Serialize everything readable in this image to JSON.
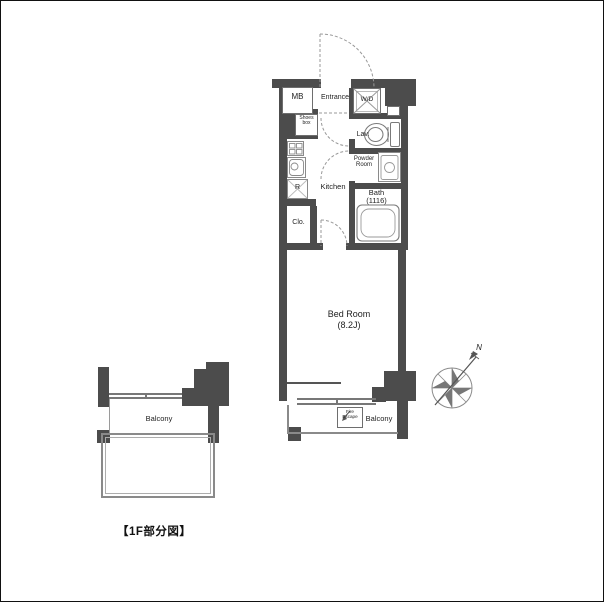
{
  "colors": {
    "wall": "#4c4c4c",
    "line": "#808080",
    "line_light": "#aaaaaa",
    "text": "#1e1e1e"
  },
  "caption": "【1F部分図】",
  "compass": {
    "north_label": "N"
  },
  "unit": {
    "mb": "MB",
    "entrance": "Entrance",
    "washer_dryer": "W/D",
    "shoes_box": {
      "line1": "Shoes",
      "line2": "box"
    },
    "lavatory": "Lav.",
    "powder_room": {
      "line1": "Powder",
      "line2": "Room"
    },
    "kitchen": "Kitchen",
    "refrigerator": "R",
    "bath": {
      "line1": "Bath",
      "line2": "(1116)"
    },
    "closet": "Clo.",
    "bedroom": {
      "line1": "Bed Room",
      "line2": "(8.2J)"
    },
    "balcony": "Balcony",
    "fire_escape": {
      "line1": "Fire",
      "line2": "Escape"
    }
  },
  "first_floor": {
    "balcony": "Balcony"
  }
}
